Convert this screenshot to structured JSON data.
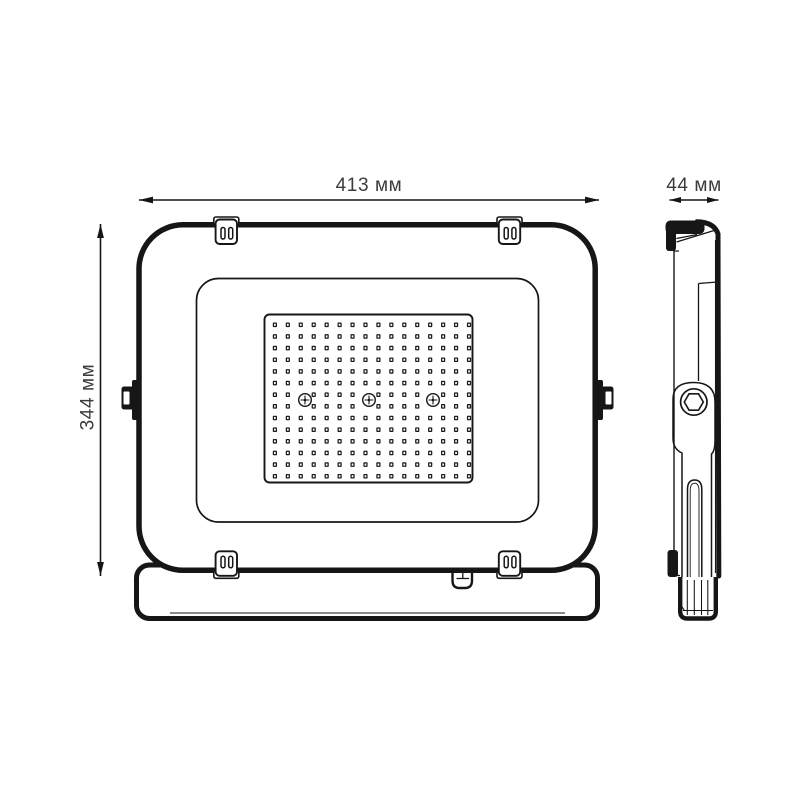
{
  "drawing_type": "technical-dimension-drawing",
  "subject": "led-floodlight",
  "front_view": {
    "width_label": "413 мм",
    "height_label": "344 мм"
  },
  "side_view": {
    "depth_label": "44 мм"
  },
  "led_grid": {
    "cols": 16,
    "rows": 14
  },
  "screws": {
    "count": 3
  },
  "mounting_clips": {
    "count": 4
  },
  "colors": {
    "background": "#ffffff",
    "line": "#161616",
    "text": "#3b3b3b"
  }
}
